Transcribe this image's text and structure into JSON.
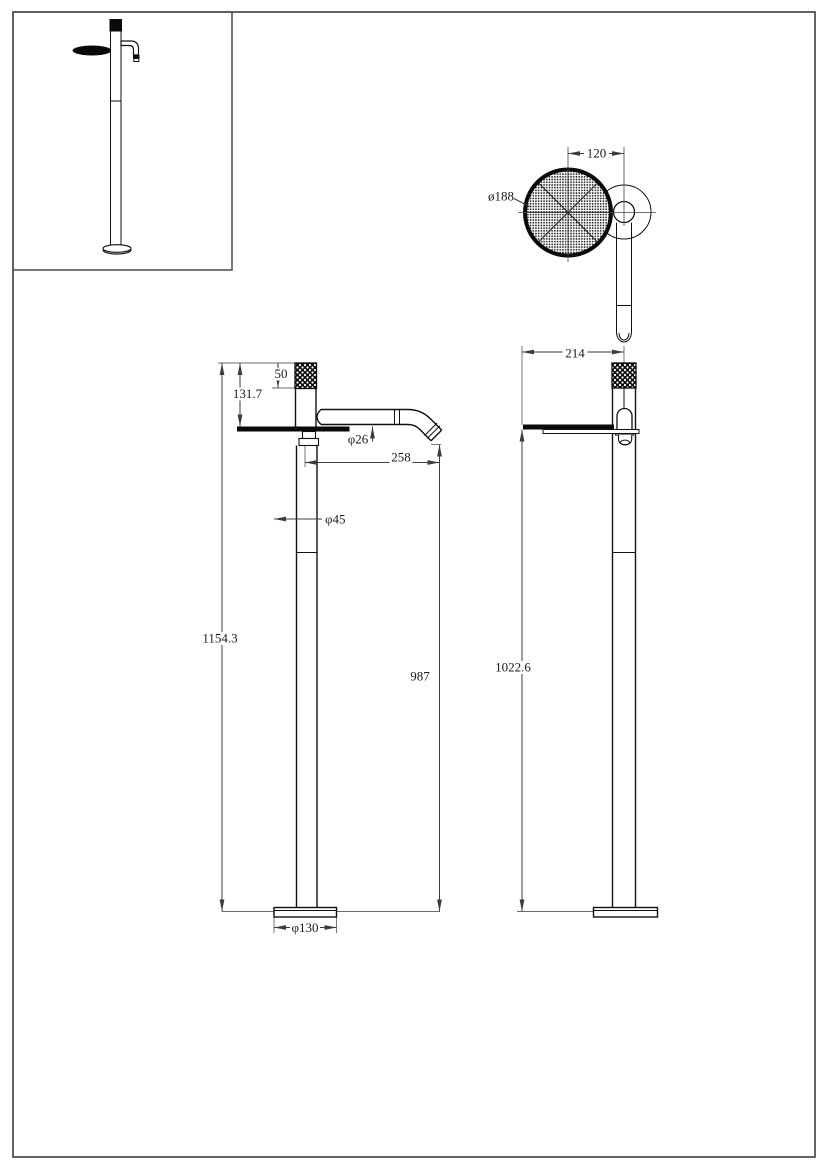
{
  "dimensions": {
    "top_view": {
      "handle_offset": "120",
      "handle_diameter": "ø188"
    },
    "front_view": {
      "cap_height": "50",
      "upper_section_height": "131.7",
      "spout_diameter": "φ26",
      "spout_reach": "258",
      "column_diameter": "φ45",
      "total_height": "1154.3",
      "spout_outlet_height": "987",
      "base_diameter": "φ130"
    },
    "side_view": {
      "handle_depth": "214",
      "handle_center_height": "1022.6"
    }
  },
  "colors": {
    "object_line": "#111111",
    "dimension_line": "#3c3c3c",
    "fill": "#ffffff"
  }
}
